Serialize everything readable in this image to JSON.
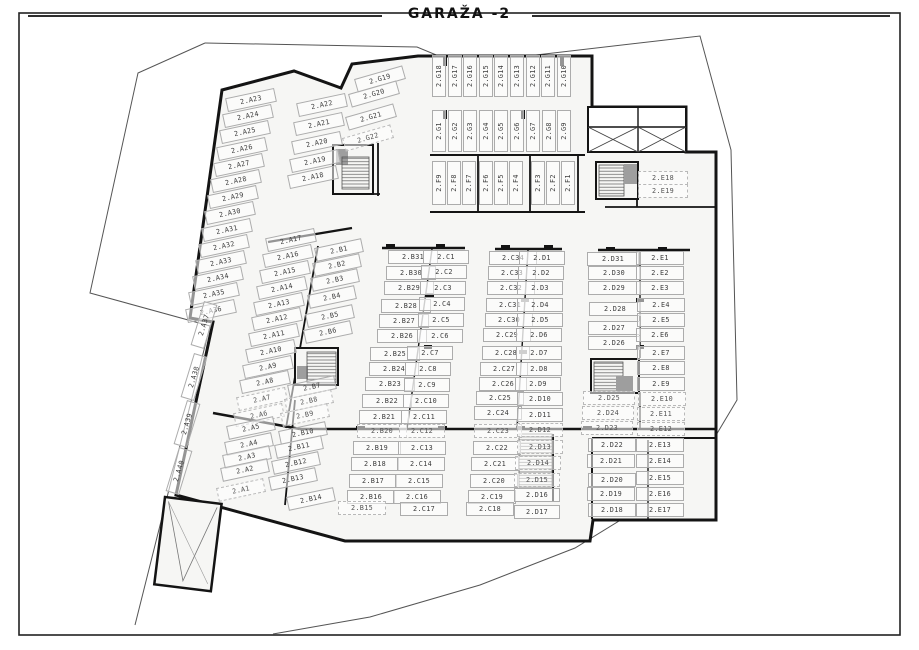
{
  "plan": {
    "floor_label": "GARAŽA -2",
    "colors": {
      "wall": "#141414",
      "building_fill": "#f6f6f4",
      "site_boundary": "#555555",
      "stall_border": "#acacac",
      "stall_text": "#3c3c3c",
      "stair_fill": "#9e9e9e"
    },
    "icon_legend": {
      "stair-icon": "hatched block = staircase",
      "elevator-icon": "gray block = elevator",
      "shaft-icon": "box with X = ventilation shaft",
      "ramp-icon": "V-marked slab = vehicle ramp"
    },
    "stall_groups": [
      {
        "id": "a-left",
        "angle": -12,
        "w": 48,
        "stalls": [
          [
            "2.A23",
            251,
            100
          ],
          [
            "2.A24",
            248,
            116
          ],
          [
            "2.A25",
            245,
            132
          ],
          [
            "2.A26",
            242,
            149
          ],
          [
            "2.A27",
            239,
            165
          ],
          [
            "2.A28",
            236,
            181
          ],
          [
            "2.A29",
            233,
            197
          ],
          [
            "2.A30",
            230,
            213
          ],
          [
            "2.A31",
            227,
            230
          ],
          [
            "2.A32",
            224,
            246
          ],
          [
            "2.A33",
            221,
            262
          ],
          [
            "2.A34",
            218,
            278
          ],
          [
            "2.A35",
            214,
            294
          ],
          [
            "2.A36",
            211,
            311
          ]
        ]
      },
      {
        "id": "a-vertical",
        "angle": -73,
        "w": 44,
        "stalls": [
          [
            "2.A37",
            204,
            325
          ],
          [
            "2.A38",
            194,
            377
          ],
          [
            "2.A39",
            187,
            424
          ],
          [
            "2.A40",
            179,
            471
          ]
        ]
      },
      {
        "id": "a-top",
        "angle": -12,
        "w": 48,
        "stalls": [
          [
            "2.A22",
            322,
            105
          ],
          [
            "2.A21",
            319,
            124
          ],
          [
            "2.A20",
            317,
            143
          ],
          [
            "2.A19",
            315,
            161
          ],
          [
            "2.A18",
            313,
            177
          ]
        ]
      },
      {
        "id": "a-mid",
        "angle": -12,
        "w": 48,
        "stalls": [
          [
            "2.A17",
            291,
            240
          ],
          [
            "2.A16",
            288,
            256
          ],
          [
            "2.A15",
            285,
            272
          ],
          [
            "2.A14",
            282,
            288
          ],
          [
            "2.A13",
            279,
            304
          ],
          [
            "2.A12",
            277,
            319
          ],
          [
            "2.A11",
            274,
            335
          ],
          [
            "2.A10",
            271,
            351
          ],
          [
            "2.A9",
            268,
            367
          ],
          [
            "2.A8",
            265,
            382
          ],
          [
            "2.A7",
            262,
            399,
            1
          ],
          [
            "2.A6",
            259,
            415,
            1
          ]
        ]
      },
      {
        "id": "a-bottom",
        "angle": -12,
        "w": 46,
        "stalls": [
          [
            "2.A5",
            251,
            428
          ],
          [
            "2.A4",
            249,
            444
          ],
          [
            "2.A3",
            247,
            457
          ],
          [
            "2.A2",
            245,
            470
          ],
          [
            "2.A1",
            241,
            490,
            1
          ]
        ]
      },
      {
        "id": "b-upper",
        "angle": -12,
        "w": 46,
        "stalls": [
          [
            "2.B1",
            339,
            250
          ],
          [
            "2.B2",
            337,
            265
          ],
          [
            "2.B3",
            335,
            280
          ],
          [
            "2.B4",
            332,
            297
          ],
          [
            "2.B5",
            330,
            316
          ],
          [
            "2.B6",
            328,
            332
          ]
        ]
      },
      {
        "id": "b-mid",
        "angle": -12,
        "w": 46,
        "stalls": [
          [
            "2.B7",
            312,
            387
          ],
          [
            "2.B8",
            309,
            401,
            1
          ],
          [
            "2.B9",
            305,
            415,
            1
          ]
        ]
      },
      {
        "id": "b-low",
        "angle": -12,
        "w": 46,
        "stalls": [
          [
            "2.B10",
            303,
            433
          ],
          [
            "2.B11",
            299,
            447
          ],
          [
            "2.B12",
            296,
            463
          ],
          [
            "2.B13",
            293,
            479
          ],
          [
            "2.B14",
            311,
            499
          ]
        ]
      },
      {
        "id": "b-column",
        "angle": 0,
        "w": 48,
        "stalls": [
          [
            "2.B31",
            413,
            257
          ],
          [
            "2.B30",
            411,
            273
          ],
          [
            "2.B29",
            409,
            288
          ],
          [
            "2.B28",
            406,
            306
          ],
          [
            "2.B27",
            404,
            321
          ],
          [
            "2.B26",
            402,
            336
          ],
          [
            "2.B25",
            395,
            354
          ],
          [
            "2.B24",
            394,
            369
          ],
          [
            "2.B23",
            390,
            384
          ],
          [
            "2.B22",
            387,
            401
          ],
          [
            "2.B21",
            384,
            417
          ],
          [
            "2.B20",
            382,
            431,
            1
          ]
        ]
      },
      {
        "id": "c-column-1",
        "angle": 0,
        "w": 44,
        "stalls": [
          [
            "2.C1",
            446,
            257
          ],
          [
            "2.C2",
            444,
            272
          ],
          [
            "2.C3",
            443,
            288
          ],
          [
            "2.C4",
            442,
            304
          ],
          [
            "2.C5",
            441,
            320
          ],
          [
            "2.C6",
            440,
            336
          ],
          [
            "2.C7",
            430,
            353
          ],
          [
            "2.C8",
            428,
            369
          ],
          [
            "2.C9",
            427,
            385
          ],
          [
            "2.C10",
            426,
            401
          ],
          [
            "2.C11",
            424,
            417
          ],
          [
            "2.C12",
            422,
            431,
            1
          ]
        ]
      },
      {
        "id": "c-column-2",
        "angle": 0,
        "w": 46,
        "stalls": [
          [
            "2.C34",
            513,
            258
          ],
          [
            "2.C33",
            512,
            273
          ],
          [
            "2.C32",
            511,
            288
          ],
          [
            "2.C31",
            510,
            305
          ],
          [
            "2.C30",
            509,
            320
          ],
          [
            "2.C29",
            507,
            335
          ],
          [
            "2.C28",
            506,
            353
          ],
          [
            "2.C27",
            504,
            369
          ],
          [
            "2.C26",
            503,
            384
          ],
          [
            "2.C25",
            500,
            398
          ],
          [
            "2.C24",
            498,
            413
          ],
          [
            "2.C23",
            498,
            431,
            1
          ]
        ]
      },
      {
        "id": "d-column-1",
        "angle": 0,
        "w": 44,
        "stalls": [
          [
            "2.D1",
            542,
            258
          ],
          [
            "2.D2",
            541,
            273
          ],
          [
            "2.D3",
            540,
            288
          ],
          [
            "2.D4",
            540,
            305
          ],
          [
            "2.D5",
            540,
            320
          ],
          [
            "2.D6",
            539,
            335
          ],
          [
            "2.D7",
            539,
            353
          ],
          [
            "2.D8",
            539,
            369
          ],
          [
            "2.D9",
            538,
            384
          ],
          [
            "2.D10",
            540,
            399
          ],
          [
            "2.D11",
            540,
            415
          ],
          [
            "2.D12",
            540,
            430,
            1
          ]
        ]
      },
      {
        "id": "d-column-2",
        "angle": 0,
        "w": 50,
        "stalls": [
          [
            "2.D31",
            613,
            259
          ],
          [
            "2.D30",
            614,
            273
          ],
          [
            "2.D29",
            614,
            288
          ],
          [
            "2.D28",
            615,
            309
          ],
          [
            "2.D27",
            614,
            328
          ],
          [
            "2.D26",
            614,
            343
          ]
        ]
      },
      {
        "id": "d-column-3",
        "angle": 0,
        "w": 50,
        "stalls": [
          [
            "2.D25",
            609,
            398,
            1
          ],
          [
            "2.D24",
            608,
            413,
            1
          ],
          [
            "2.D23",
            607,
            428,
            1
          ]
        ]
      },
      {
        "id": "e-column",
        "angle": 0,
        "w": 46,
        "stalls": [
          [
            "2.E1",
            660,
            258
          ],
          [
            "2.E2",
            660,
            273
          ],
          [
            "2.E3",
            660,
            288
          ],
          [
            "2.E4",
            661,
            305
          ],
          [
            "2.E5",
            661,
            320
          ],
          [
            "2.E6",
            660,
            335
          ],
          [
            "2.E7",
            661,
            353
          ],
          [
            "2.E8",
            661,
            368
          ],
          [
            "2.E9",
            661,
            384
          ],
          [
            "2.E10",
            662,
            399,
            1
          ],
          [
            "2.E11",
            661,
            414,
            1
          ],
          [
            "2.E12",
            661,
            429,
            1
          ]
        ]
      },
      {
        "id": "b-bottom",
        "angle": 0,
        "w": 46,
        "stalls": [
          [
            "2.B19",
            377,
            448
          ],
          [
            "2.B18",
            375,
            464
          ],
          [
            "2.B17",
            373,
            481
          ],
          [
            "2.B16",
            371,
            497
          ],
          [
            "2.B15",
            362,
            508,
            1
          ]
        ]
      },
      {
        "id": "c-bottom-1",
        "angle": 0,
        "w": 46,
        "stalls": [
          [
            "2.C13",
            422,
            448
          ],
          [
            "2.C14",
            421,
            464
          ],
          [
            "2.C15",
            419,
            481
          ],
          [
            "2.C16",
            417,
            497
          ],
          [
            "2.C17",
            424,
            509
          ]
        ]
      },
      {
        "id": "c-bottom-2",
        "angle": 0,
        "w": 46,
        "stalls": [
          [
            "2.C22",
            497,
            448
          ],
          [
            "2.C21",
            495,
            464
          ],
          [
            "2.C20",
            494,
            481
          ],
          [
            "2.C19",
            492,
            497
          ],
          [
            "2.C18",
            490,
            509
          ]
        ]
      },
      {
        "id": "d-bottom-1",
        "angle": 0,
        "w": 44,
        "stalls": [
          [
            "2.D13",
            540,
            447,
            1
          ],
          [
            "2.D14",
            538,
            463,
            1
          ],
          [
            "2.D15",
            537,
            480,
            1
          ],
          [
            "2.D16",
            537,
            495
          ],
          [
            "2.D17",
            537,
            512
          ]
        ]
      },
      {
        "id": "d-bottom-2",
        "angle": 0,
        "w": 46,
        "stalls": [
          [
            "2.D22",
            612,
            445
          ],
          [
            "2.D21",
            611,
            461
          ],
          [
            "2.D20",
            612,
            480
          ],
          [
            "2.D19",
            611,
            494
          ],
          [
            "2.D18",
            612,
            510
          ]
        ]
      },
      {
        "id": "e-bottom",
        "angle": 0,
        "w": 46,
        "stalls": [
          [
            "2.E13",
            660,
            445
          ],
          [
            "2.E14",
            660,
            461
          ],
          [
            "2.E15",
            660,
            478
          ],
          [
            "2.E16",
            660,
            494
          ],
          [
            "2.E17",
            660,
            510
          ]
        ]
      },
      {
        "id": "e-top",
        "angle": 0,
        "w": 48,
        "stalls": [
          [
            "2.E18",
            663,
            178,
            1
          ],
          [
            "2.E19",
            663,
            191,
            1
          ]
        ]
      },
      {
        "id": "f-row",
        "angle": -90,
        "w": 42,
        "stalls": [
          [
            "2.F9",
            439,
            183
          ],
          [
            "2.F8",
            454,
            183
          ],
          [
            "2.F7",
            469,
            183
          ],
          [
            "2.F6",
            486,
            183
          ],
          [
            "2.F5",
            501,
            183
          ],
          [
            "2.F4",
            516,
            183
          ],
          [
            "2.F3",
            538,
            183
          ],
          [
            "2.F2",
            553,
            183
          ],
          [
            "2.F1",
            568,
            183
          ]
        ]
      },
      {
        "id": "g-row-top",
        "angle": -90,
        "w": 40,
        "stalls": [
          [
            "2.G18",
            439,
            76
          ],
          [
            "2.G17",
            455,
            76
          ],
          [
            "2.G16",
            470,
            76
          ],
          [
            "2.G15",
            486,
            76
          ],
          [
            "2.G14",
            501,
            76
          ],
          [
            "2.G13",
            517,
            76
          ],
          [
            "2.G12",
            533,
            76
          ],
          [
            "2.G11",
            548,
            76
          ],
          [
            "2.G10",
            564,
            76
          ]
        ]
      },
      {
        "id": "g-row-mid",
        "angle": -90,
        "w": 40,
        "stalls": [
          [
            "2.G1",
            439,
            131
          ],
          [
            "2.G2",
            455,
            131
          ],
          [
            "2.G3",
            470,
            131
          ],
          [
            "2.G4",
            486,
            131
          ],
          [
            "2.G5",
            501,
            131
          ],
          [
            "2.G6",
            517,
            131
          ],
          [
            "2.G7",
            533,
            131
          ],
          [
            "2.G8",
            549,
            131
          ],
          [
            "2.G9",
            564,
            131
          ]
        ]
      },
      {
        "id": "g-angled",
        "angle": -16,
        "w": 48,
        "stalls": [
          [
            "2.G19",
            380,
            79
          ],
          [
            "2.G20",
            374,
            94
          ],
          [
            "2.G21",
            371,
            117
          ],
          [
            "2.G22",
            368,
            138,
            1
          ]
        ]
      }
    ]
  }
}
